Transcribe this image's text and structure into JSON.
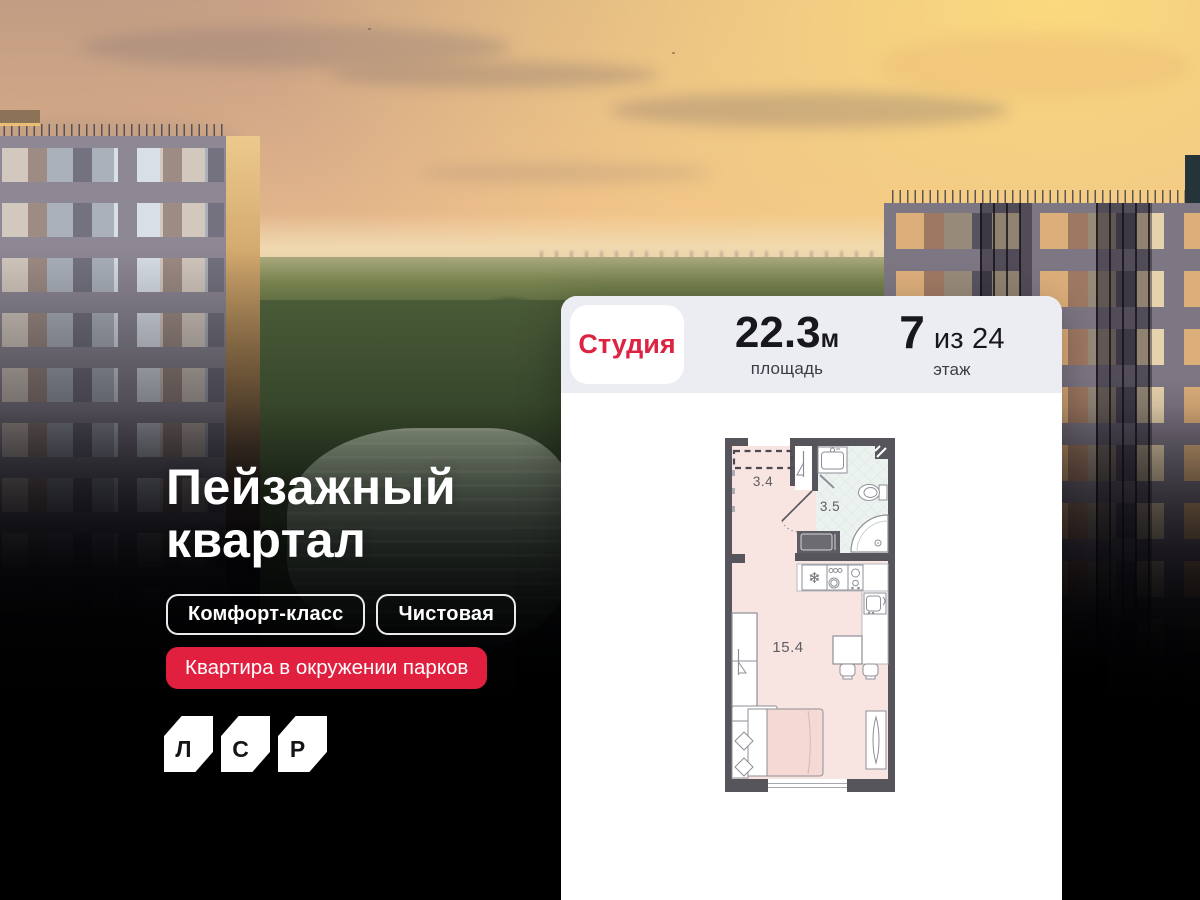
{
  "hero": {
    "title_line1": "Пейзажный",
    "title_line2": "квартал",
    "badges": [
      {
        "label": "Комфорт-класс"
      },
      {
        "label": "Чистовая"
      }
    ],
    "highlight_badge": {
      "label": "Квартира в окружении парков"
    },
    "logo": {
      "letters": [
        "Л",
        "С",
        "Р"
      ]
    }
  },
  "card": {
    "type_badge": "Студия",
    "area": {
      "value": "22.3",
      "unit": "м",
      "label": "площадь"
    },
    "floor": {
      "value": "7",
      "suffix": "из 24",
      "label": "этаж"
    }
  },
  "floor_plan": {
    "rooms": [
      {
        "area_label": "3.4"
      },
      {
        "area_label": "3.5"
      },
      {
        "area_label": "15.4"
      }
    ]
  },
  "colors": {
    "accent_red": "#e1203f",
    "chip_text_red": "#dc2342",
    "card_header_bg": "#ecedf3",
    "plan_wall": "#56555c",
    "plan_room_pink": "#f8e4e1",
    "plan_bath_tile": "#ecf2ef"
  }
}
